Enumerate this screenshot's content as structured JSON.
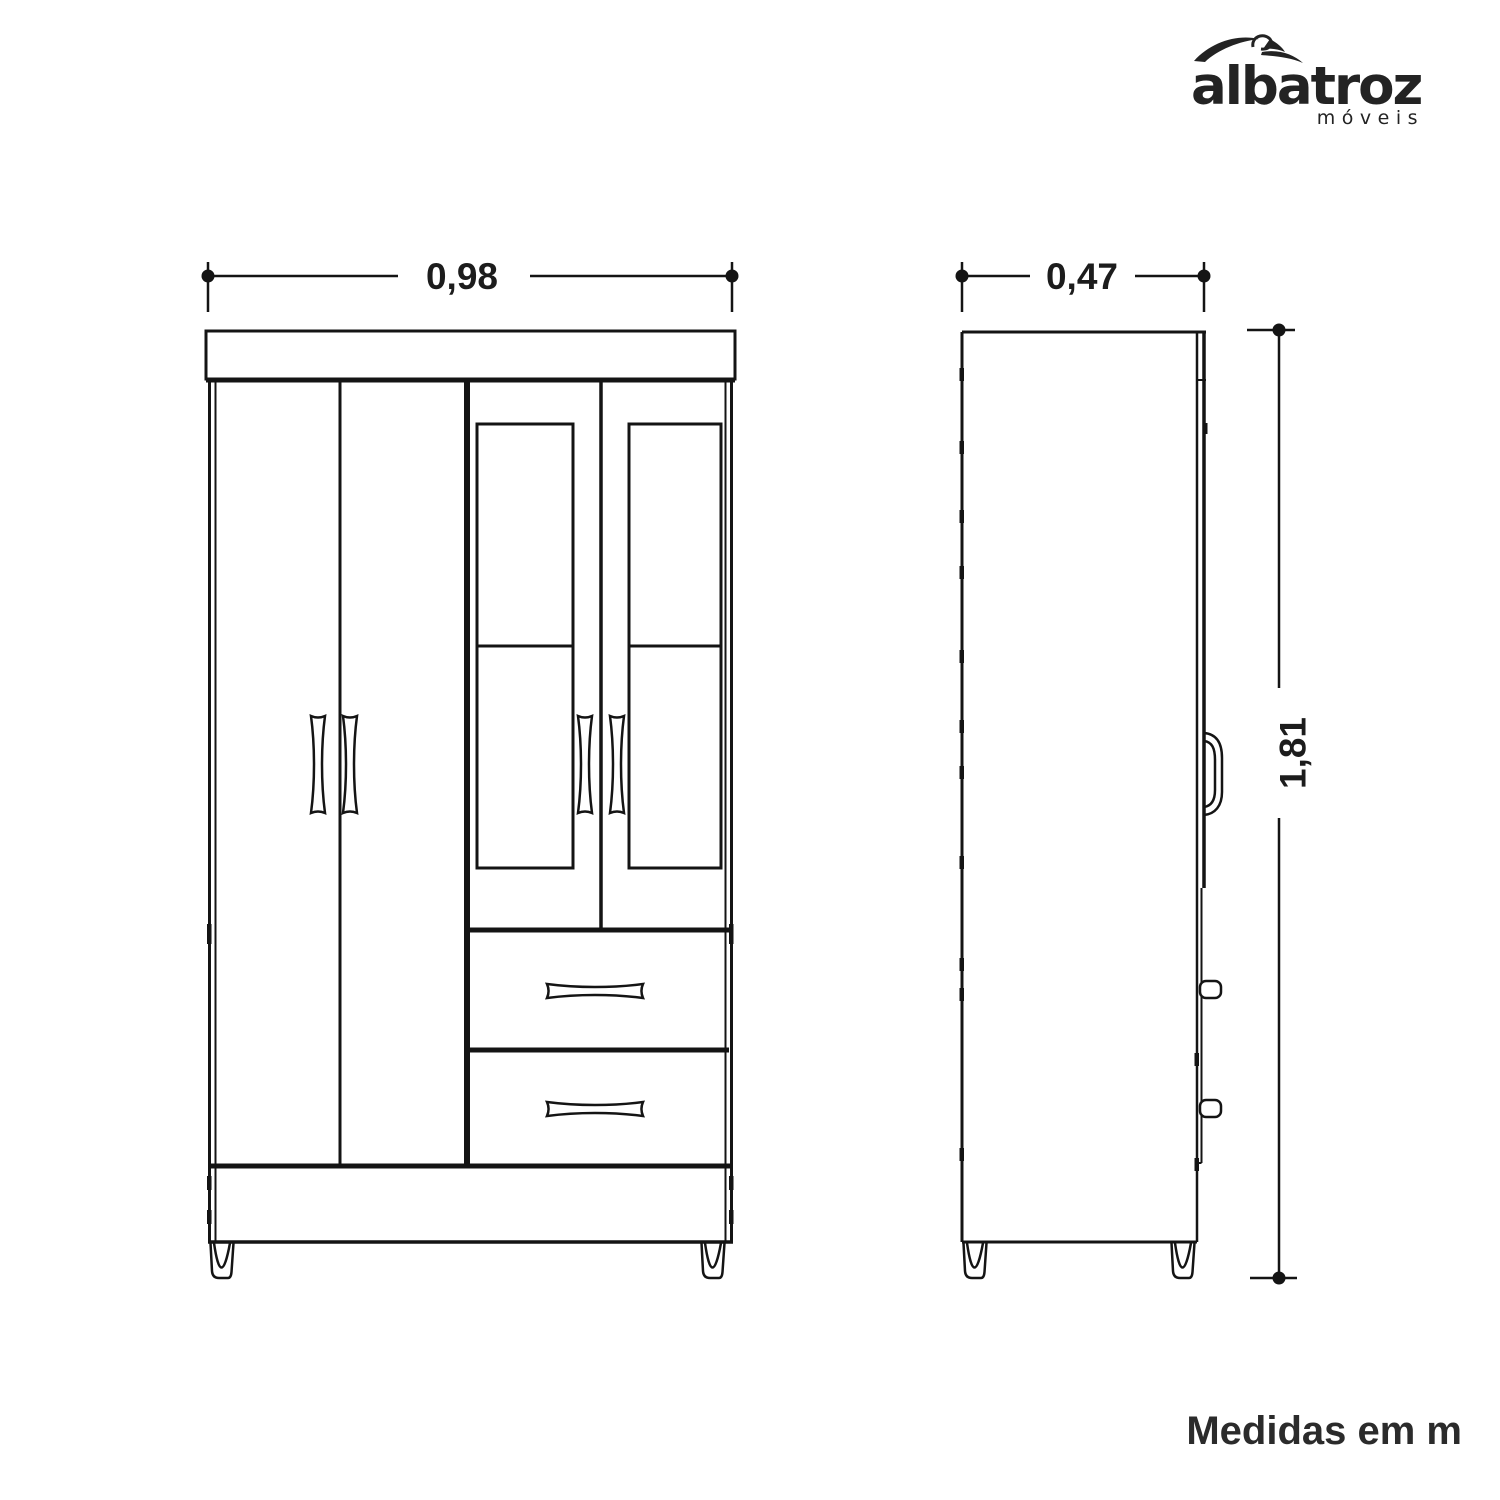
{
  "logo": {
    "brand": "albatroz",
    "subtitle": "móveis",
    "icon": "albatross-bird-swoosh"
  },
  "dimensions": {
    "front_width": "0,98",
    "side_depth": "0,47",
    "height": "1,81"
  },
  "footer": {
    "note": "Medidas em m"
  },
  "drawing": {
    "front_view": "wardrobe-front-elevation",
    "side_view": "wardrobe-side-elevation",
    "line_color": "#141414",
    "text_color": "#2b2b2b",
    "background": "#ffffff"
  }
}
